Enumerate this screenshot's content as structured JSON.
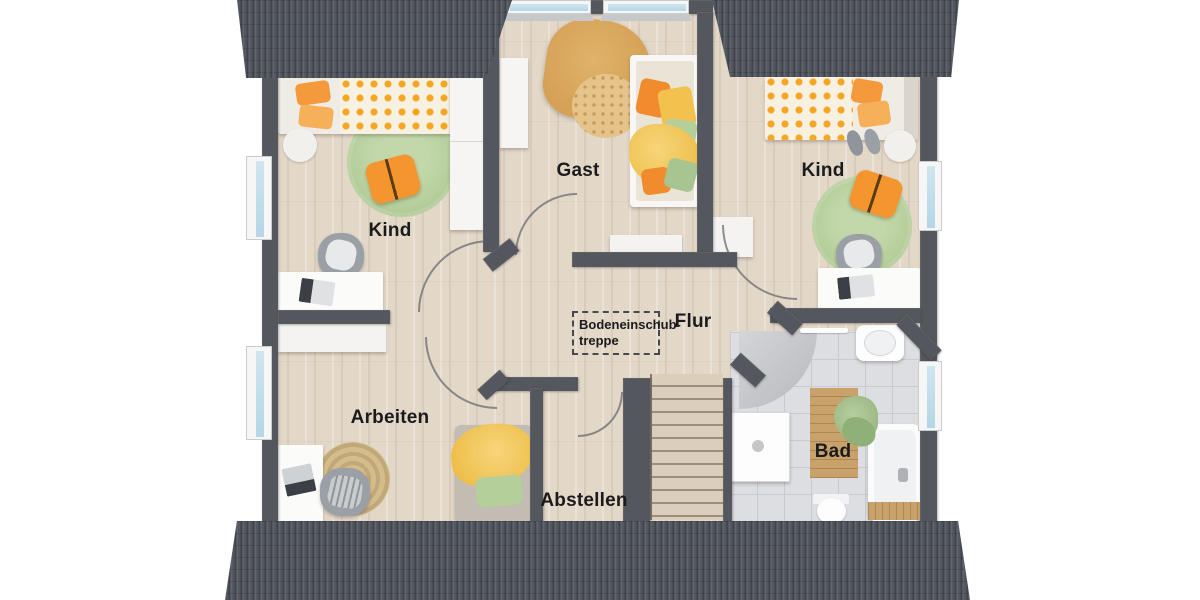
{
  "rooms": {
    "kind_left": {
      "label": "Kind"
    },
    "gast": {
      "label": "Gast"
    },
    "kind_right": {
      "label": "Kind"
    },
    "flur": {
      "label": "Flur"
    },
    "arbeiten": {
      "label": "Arbeiten"
    },
    "abstellen": {
      "label": "Abstellen"
    },
    "bad": {
      "label": "Bad"
    }
  },
  "annotations": {
    "attic_hatch": {
      "line1": "Bodeneinschub-",
      "line2": "treppe"
    }
  },
  "colors": {
    "roof": "#53575f",
    "wall": "#54575d",
    "wood_floor": "#e3d7c8",
    "tile_floor": "#dcdee1",
    "window_glass": "#bfdcea",
    "rug_green": "#b7cf9c",
    "rug_jute": "#cdb27f",
    "accent_orange": "#f4952e",
    "accent_yellow": "#f5c75e",
    "accent_sage": "#a9c795",
    "label_text": "#1b1b1d"
  }
}
